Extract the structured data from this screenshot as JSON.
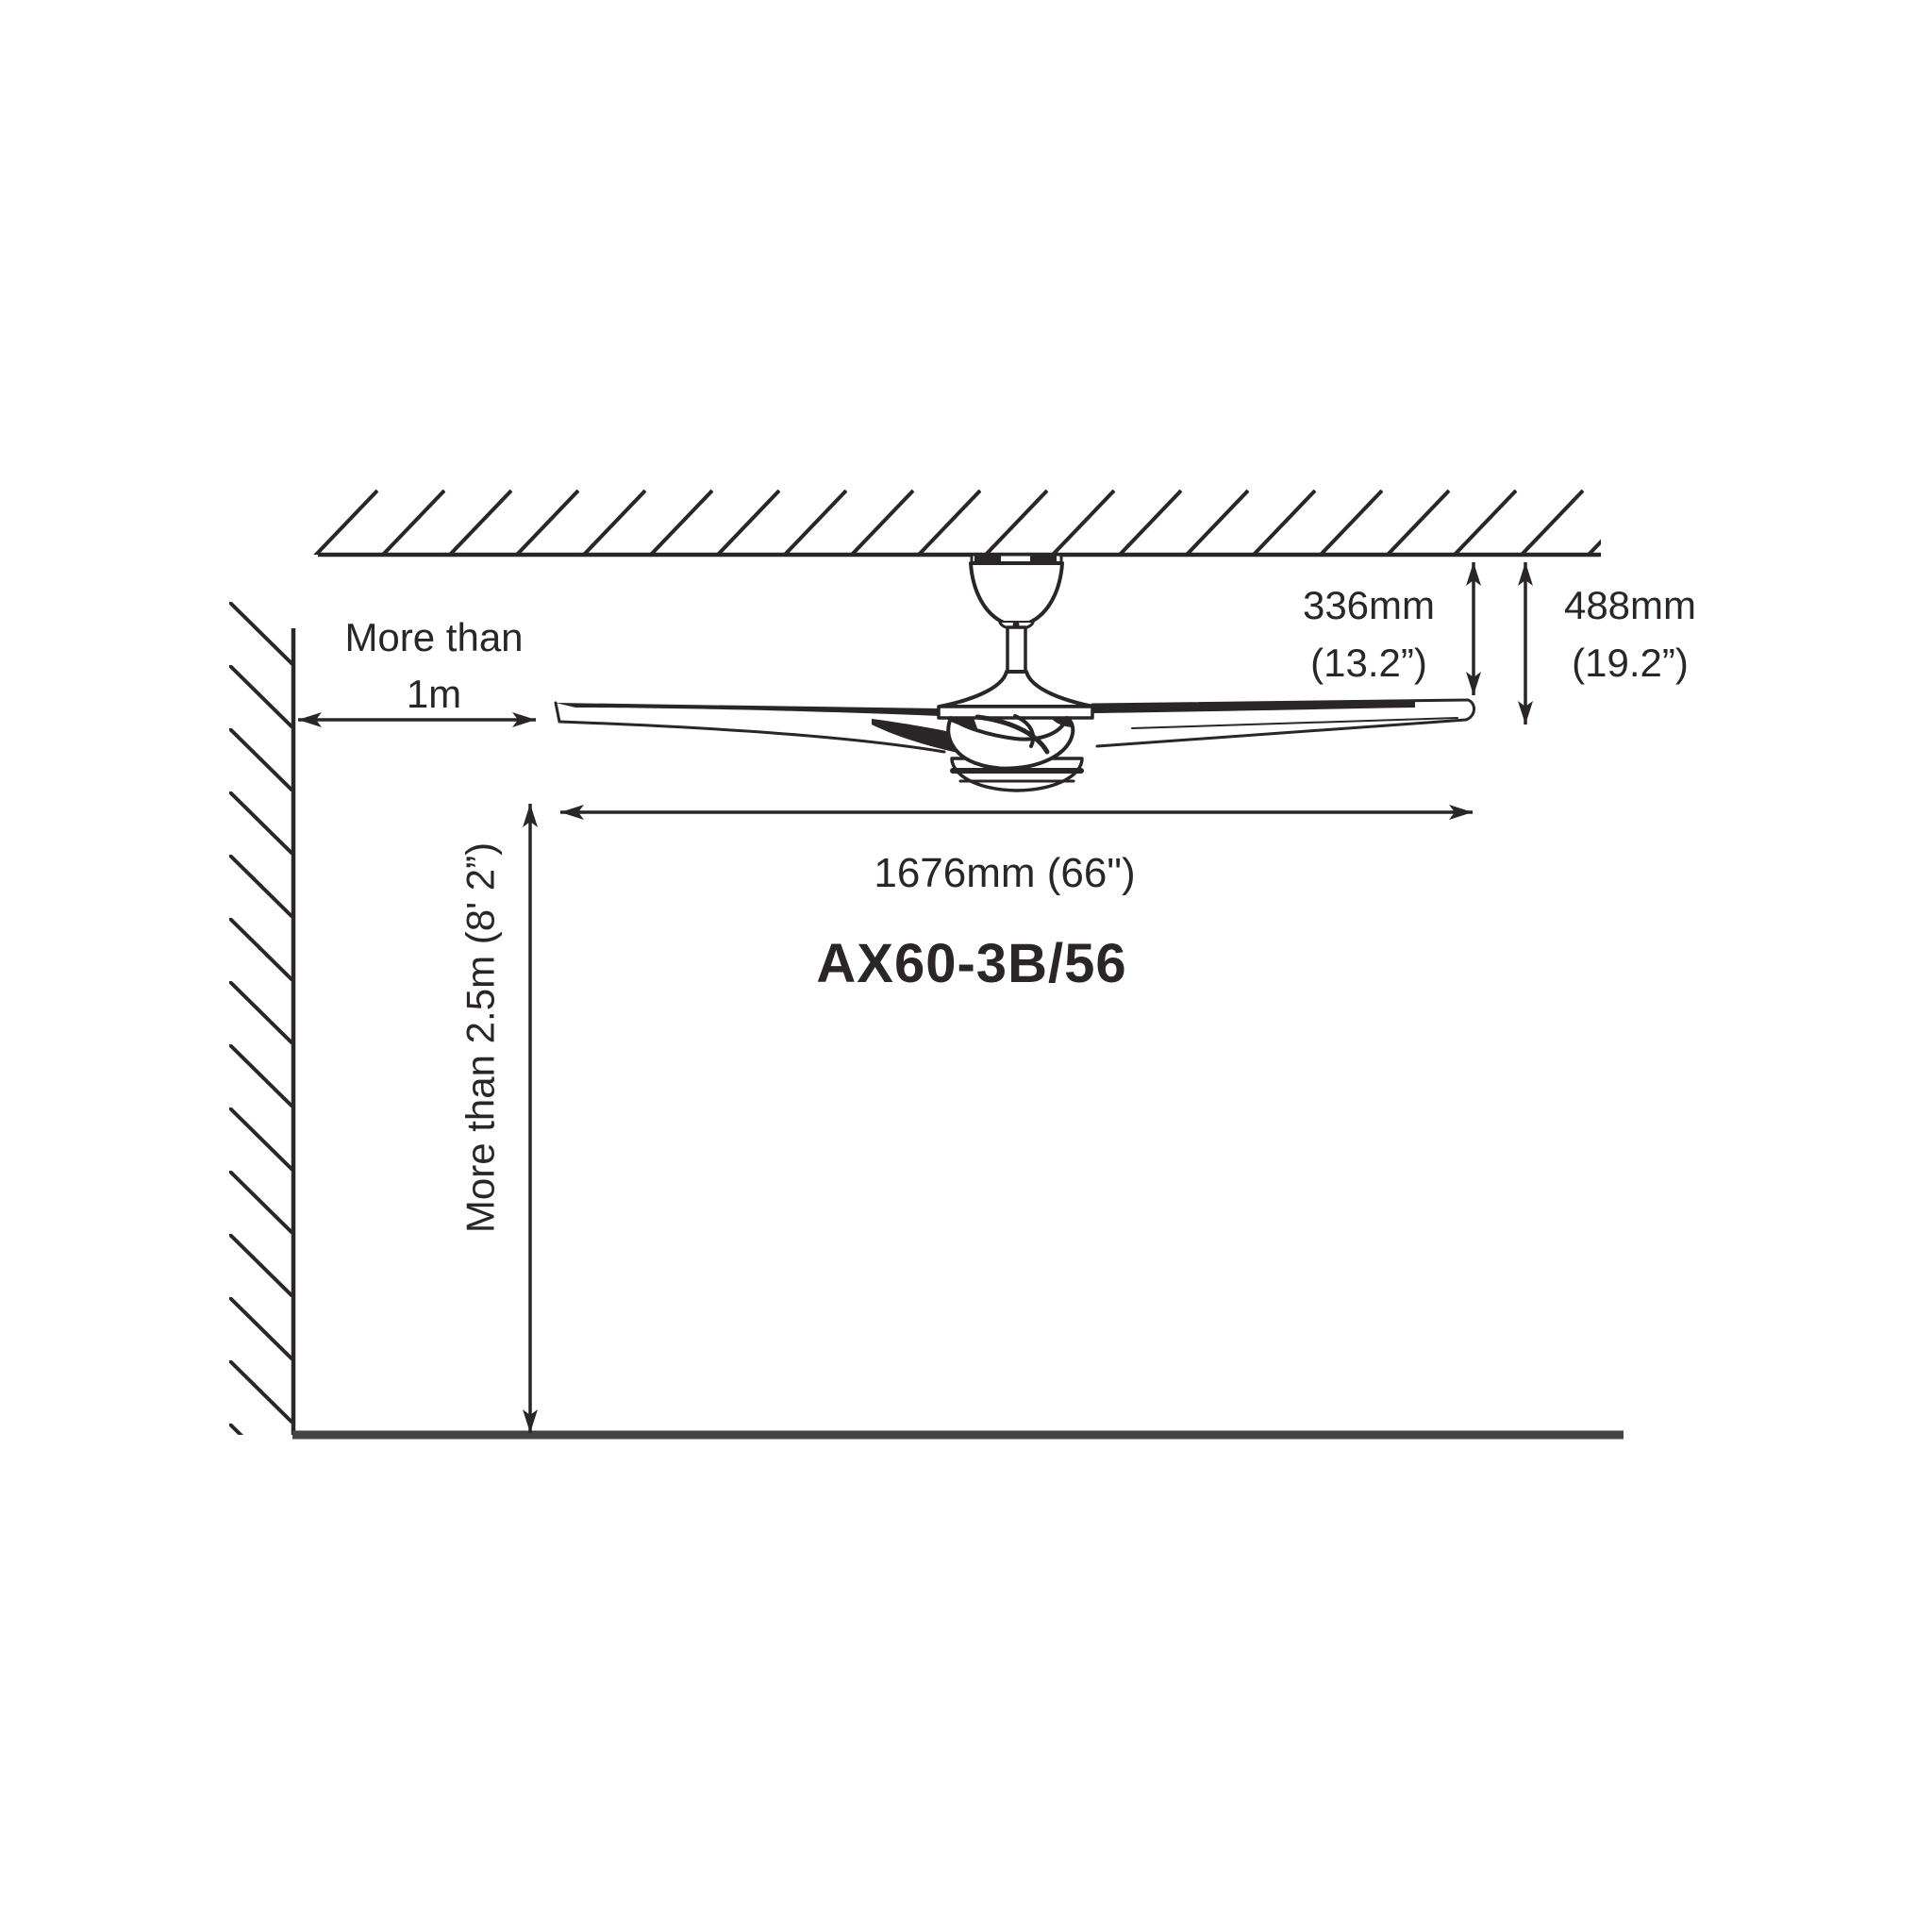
{
  "page": {
    "background": "#ffffff",
    "ink": "#2a2627",
    "floor_color": "#454545"
  },
  "labels": {
    "wall_clearance": {
      "line1": "More than",
      "line2": "1m"
    },
    "drop_to_blades": {
      "metric": "336mm",
      "imperial": "(13.2”)"
    },
    "drop_overall": {
      "metric": "488mm",
      "imperial": "(19.2”)"
    },
    "blade_span": "1676mm (66\")",
    "floor_clearance": "More than 2.5m (8' 2”)",
    "model": "AX60-3B/56"
  }
}
